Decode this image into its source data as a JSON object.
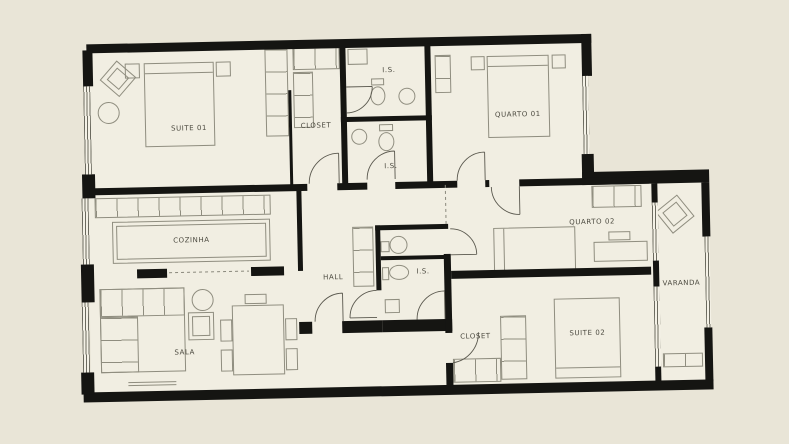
{
  "plan": {
    "type": "apartment-floor-plan",
    "rooms": [
      {
        "id": "suite-01",
        "label": "SUITE 01"
      },
      {
        "id": "closet-1",
        "label": "CLOSET"
      },
      {
        "id": "is-1",
        "label": "I.S."
      },
      {
        "id": "is-2",
        "label": "I.S."
      },
      {
        "id": "quarto-01",
        "label": "QUARTO 01"
      },
      {
        "id": "cozinha",
        "label": "COZINHA"
      },
      {
        "id": "hall",
        "label": "HALL"
      },
      {
        "id": "is-3",
        "label": "I.S."
      },
      {
        "id": "quarto-02",
        "label": "QUARTO 02"
      },
      {
        "id": "sala",
        "label": "SALA"
      },
      {
        "id": "closet-2",
        "label": "CLOSET"
      },
      {
        "id": "suite-02",
        "label": "SUITE 02"
      },
      {
        "id": "varanda",
        "label": "VARANDA"
      }
    ],
    "colors": {
      "background": "#e9e5d7",
      "floor": "#f1eee2",
      "wall": "#151512",
      "furniture": "#8f8d7f",
      "text": "#4b493f"
    }
  }
}
